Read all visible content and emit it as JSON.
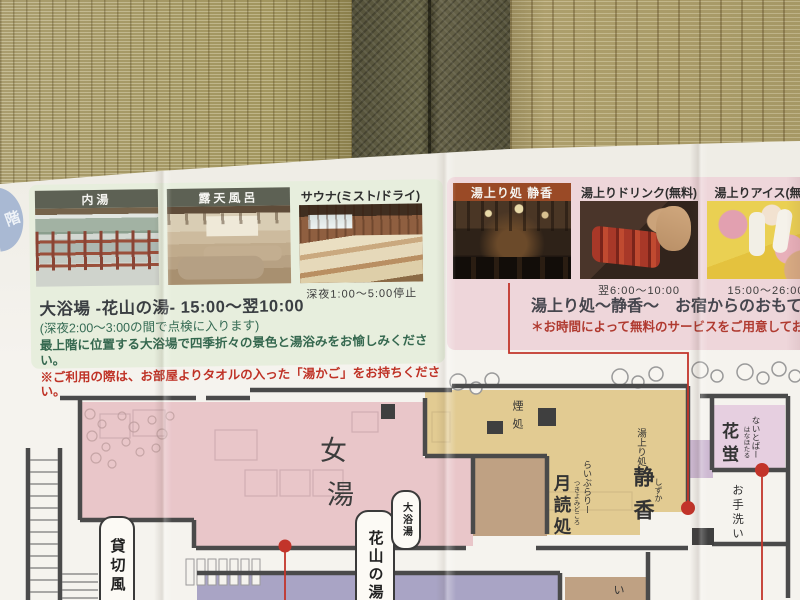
{
  "floor_tab": {
    "label": "階"
  },
  "left_panel": {
    "cards": [
      {
        "title": "内湯"
      },
      {
        "title": "露天風呂"
      },
      {
        "title": "サウナ(ミスト/ドライ)",
        "caption": "深夜1:00～5:00停止"
      }
    ],
    "heading": "大浴場 -花山の湯- 15:00～翌10:00",
    "note": "(深夜2:00～3:00の間で点検に入ります)",
    "description": "最上階に位置する大浴場で四季折々の景色と湯浴みをお愉しみください。",
    "warning": "※ご利用の際は、お部屋よりタオルの入った「湯かご」をお持ちください。"
  },
  "right_panel": {
    "cards": [
      {
        "title": "湯上り処 静香"
      },
      {
        "title": "湯上りドリンク(無料)",
        "caption": "翌6:00～10:00"
      },
      {
        "title": "湯上りアイス(無料)",
        "caption": "15:00～26:00"
      }
    ],
    "heading": "湯上り処～静香～　お宿からのおもてな",
    "note": "＊お時間によって無料のサービスをご用意してお"
  },
  "map": {
    "labels": {
      "womens_bath_1": "女",
      "womens_bath_2": "湯",
      "private_bath": "貸切風",
      "hanayama_no_yu": "花山の湯",
      "daiyokuto": "大浴湯",
      "smoking": "煙処",
      "library_sub": "らいぶらりー",
      "library_main": "月読処",
      "library_furigana": "つきよみどころ",
      "yuagari_sub": "湯上り処",
      "shizuka_main": "静香",
      "shizuka_furigana": "しずか",
      "nightbar_sub": "ないとばー",
      "hanahotaru_main": "花蛍",
      "hanahotaru_furigana": "はなほたる",
      "restroom": "お手洗い",
      "partial_room": "い"
    }
  },
  "colors": {
    "panel_green": "#e7eedd",
    "panel_pink": "#eed6da",
    "card_bar_olive": "#5d6154",
    "card_bar_rust": "#9a4a26",
    "map_pink": "#e9c6c9",
    "map_yellow": "#e2cb92",
    "map_purple": "#a9a4c5",
    "map_lavender": "#e6cfe0",
    "map_brown": "#bfa183",
    "accent_red": "#c2342a",
    "tab_blue": "#a9b9d3"
  }
}
